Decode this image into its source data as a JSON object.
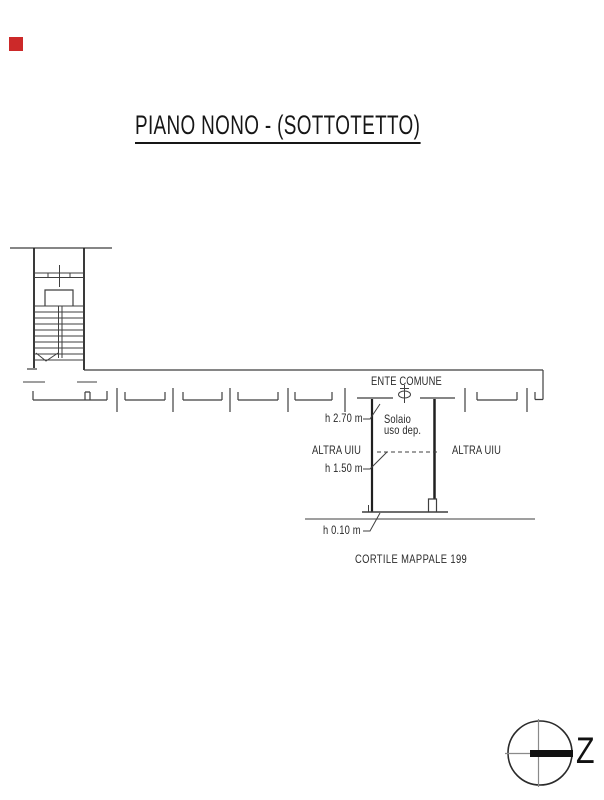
{
  "title": {
    "text": "PIANO NONO - (SOTTOTETTO)"
  },
  "marker": {
    "name": "red-square-marker",
    "color": "#cc2929"
  },
  "plan": {
    "labels": {
      "ente_comune": "ENTE COMUNE",
      "h_270": "h 2.70 m",
      "solaio_line1": "Solaio",
      "solaio_line2": "uso dep.",
      "altra_uiu_left": "ALTRA UIU",
      "altra_uiu_right": "ALTRA UIU",
      "h_150": "h 1.50 m",
      "h_010": "h 0.10 m",
      "cortile": "CORTILE MAPPALE 199"
    },
    "colors": {
      "line_thin": "#3f3f3f",
      "line_thick": "#202020",
      "crosshair_gray": "#8a8a8a"
    }
  },
  "compass": {
    "letter": "Z"
  }
}
